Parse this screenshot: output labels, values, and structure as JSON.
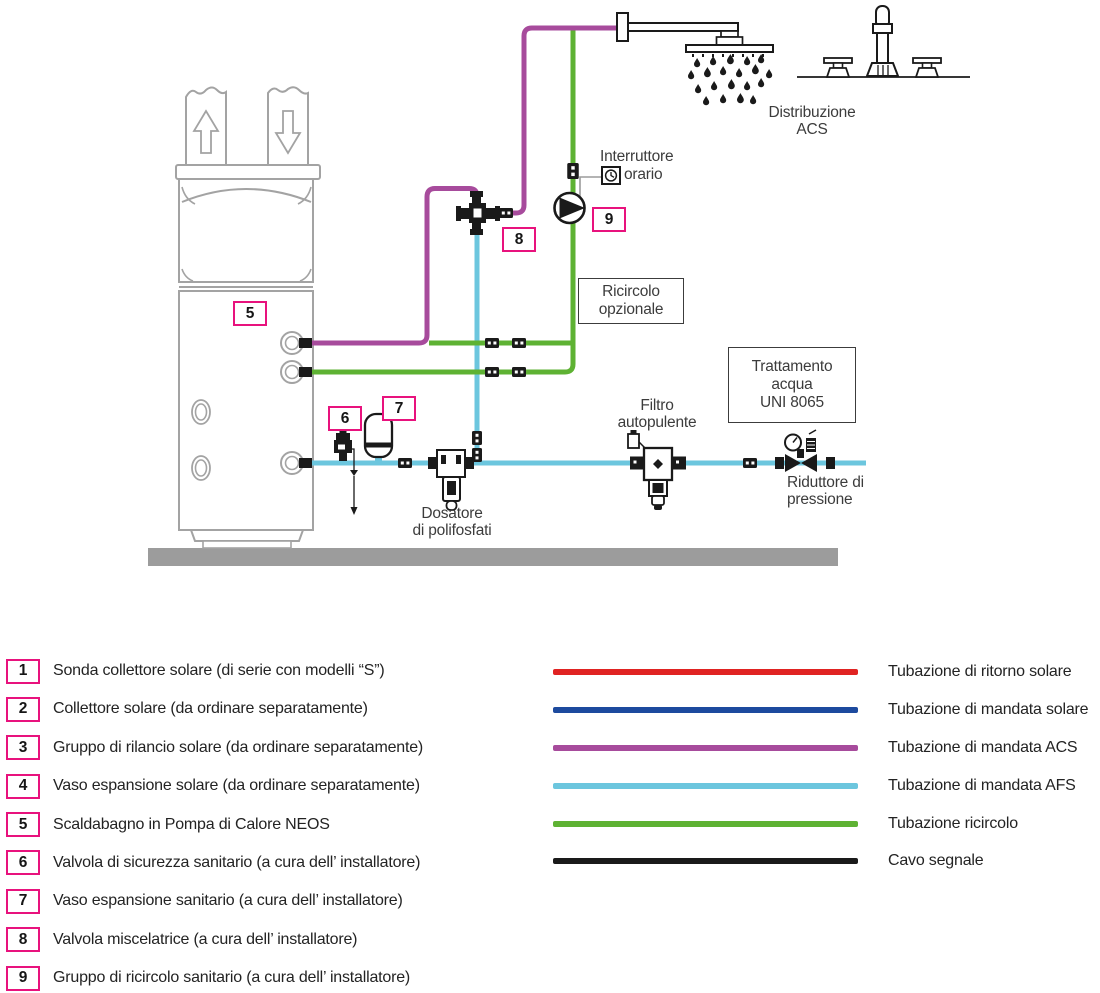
{
  "colors": {
    "pipe_acs": "#a74b9c",
    "pipe_afs": "#6cc6de",
    "pipe_ricircolo": "#5eb233",
    "solar_return": "#e02322",
    "solar_supply": "#1d4a9e",
    "signal_cable": "#1a1a1a",
    "badge_border": "#e8127d",
    "floor": "#9c9c9c",
    "tank_outline": "#a3a3a3"
  },
  "diagram": {
    "labels": {
      "distribuzione": {
        "line1": "Distribuzione",
        "line2": "ACS"
      },
      "interruttore": {
        "line1": "Interruttore",
        "line2": "orario"
      },
      "ricircolo_box": {
        "line1": "Ricircolo",
        "line2": "opzionale"
      },
      "trattamento_box": {
        "line1": "Trattamento",
        "line2": "acqua",
        "line3": "UNI 8065"
      },
      "filtro": {
        "line1": "Filtro",
        "line2": "autopulente"
      },
      "riduttore": {
        "line1": "Riduttore di",
        "line2": "pressione"
      },
      "dosatore": {
        "line1": "Dosatore",
        "line2": "di polifosfati"
      }
    },
    "badges": {
      "tank": "5",
      "safety_valve": "6",
      "expansion_vessel": "7",
      "mixing_valve": "8",
      "recirc_group": "9"
    }
  },
  "legend": {
    "items": [
      {
        "num": "1",
        "label": "Sonda collettore solare (di serie con modelli “S”)"
      },
      {
        "num": "2",
        "label": "Collettore solare (da ordinare separatamente)"
      },
      {
        "num": "3",
        "label": "Gruppo di rilancio solare (da ordinare separatamente)"
      },
      {
        "num": "4",
        "label": "Vaso espansione solare (da ordinare separatamente)"
      },
      {
        "num": "5",
        "label": "Scaldabagno in Pompa di Calore NEOS"
      },
      {
        "num": "6",
        "label": "Valvola di sicurezza sanitario (a cura dell’ installatore)"
      },
      {
        "num": "7",
        "label": "Vaso espansione sanitario (a cura dell’ installatore)"
      },
      {
        "num": "8",
        "label": "Valvola miscelatrice (a cura dell’ installatore)"
      },
      {
        "num": "9",
        "label": "Gruppo di ricircolo sanitario (a cura dell’ installatore)"
      }
    ],
    "lines": [
      {
        "label": "Tubazione di ritorno solare",
        "color": "#e02322"
      },
      {
        "label": "Tubazione di mandata solare",
        "color": "#1d4a9e"
      },
      {
        "label": "Tubazione di mandata ACS",
        "color": "#a74b9c"
      },
      {
        "label": "Tubazione di mandata AFS",
        "color": "#6cc6de"
      },
      {
        "label": "Tubazione ricircolo",
        "color": "#5eb233"
      },
      {
        "label": "Cavo segnale",
        "color": "#1a1a1a"
      }
    ]
  }
}
